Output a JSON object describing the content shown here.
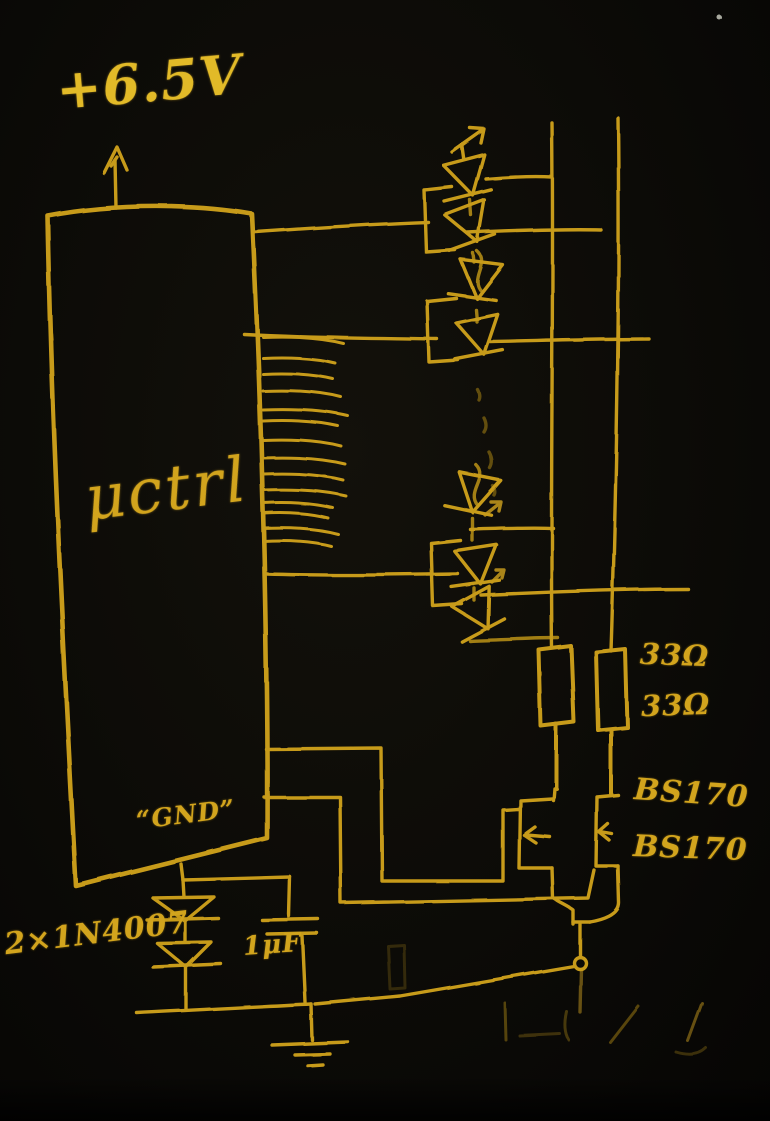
{
  "canvas": {
    "background_color": "#0c0b07",
    "ink_color": "#d2a41d",
    "ink_bright_color": "#e2ba28",
    "description": "hand-drawn LED driver circuit sketch, chalk on black"
  },
  "labels": {
    "supply": "+6.5V",
    "mcu": "μctrl",
    "gnd": "“GND”",
    "diodes": "2×1N4007",
    "cap": "1μF",
    "resistors": [
      "33Ω",
      "33Ω"
    ],
    "transistors": [
      "BS170",
      "BS170"
    ]
  },
  "components": {
    "mcu": "microcontroller block with pin stubs",
    "led_chain": "vertical chain of LED symbols with light-emission arrows and dotted continuation",
    "rails": "two vertical wire rails feeding two resistors",
    "resistors": "two 33 ohm resistors",
    "transistors": "two BS170 n-channel MOSFETs",
    "gnd_network": "virtual GND through 2x 1N4007 series diodes in parallel with 1uF capacitor to earth ground"
  }
}
